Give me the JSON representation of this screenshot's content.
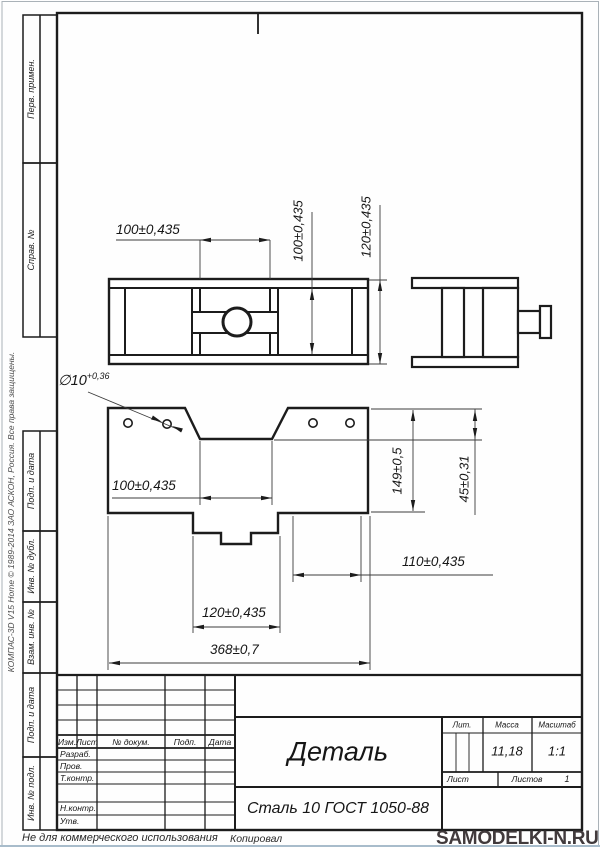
{
  "margin_labels": {
    "perv": "Перв. примен.",
    "sprav": "Справ. №",
    "podp1": "Подп. и дата",
    "inv_dubl": "Инв. № дубл.",
    "vzam": "Взам. инв. №",
    "podp2": "Подп. и дата",
    "inv_podl": "Инв. № подл."
  },
  "copyright": "КОМПАС-3D V15 Home © 1989-2014 ЗАО АСКОН, Россия. Все права защищены.",
  "dims": {
    "top_view": {
      "width": "100±0,435",
      "inner_height": "100±0,435",
      "overall_height": "120±0,435"
    },
    "front_view": {
      "hole_dia": "∅10",
      "hole_tol": "+0,36",
      "notch_width": "100±0,435",
      "height": "149±0,5",
      "notch_depth": "45±0,31",
      "right_offset": "110±0,435",
      "step_width": "120±0,435",
      "overall_width": "368±0,7"
    }
  },
  "title_block": {
    "title": "Деталь",
    "material": "Сталь 10  ГОСТ 1050-88",
    "columns": {
      "izm": "Изм.",
      "list": "Лист",
      "doc": "№ докум.",
      "podp": "Подп.",
      "data": "Дата"
    },
    "rows": {
      "razrab": "Разраб.",
      "prov": "Пров.",
      "tkontr": "Т.контр.",
      "nkontr": "Н.контр.",
      "utv": "Утв."
    },
    "lit_label": "Лит.",
    "mass_label": "Масса",
    "scale_label": "Масштаб",
    "mass": "11,18",
    "scale": "1:1",
    "sheet_label": "Лист",
    "sheets_label": "Листов",
    "sheets_value": "1"
  },
  "footer": {
    "left": "Не для коммерческого использования",
    "center": "Копировал",
    "watermark": "SAMODELKI-N.RU"
  }
}
